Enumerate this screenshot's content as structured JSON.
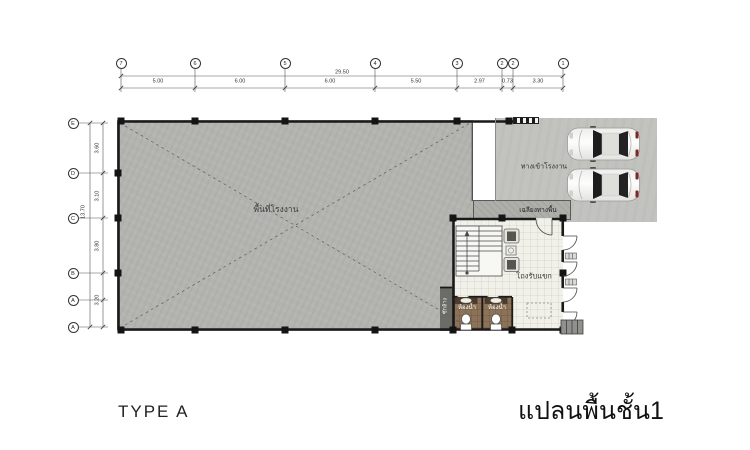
{
  "titles": {
    "type": "TYPE A",
    "plan": "แปลนพื้นชั้น1"
  },
  "grid": {
    "top": {
      "total": "29.50",
      "bubbles": [
        "7",
        "6",
        "5",
        "4",
        "3",
        "2",
        "2",
        "1"
      ],
      "segments": [
        "5.00",
        "6.00",
        "6.00",
        "5.50",
        "2.97",
        "0.73",
        "3.30"
      ]
    },
    "left": {
      "total": "13.70",
      "bubbles": [
        "E",
        "D",
        "C",
        "B",
        "A",
        "A"
      ],
      "segments": [
        "3.60",
        "3.10",
        "3.80",
        "3.20"
      ]
    }
  },
  "labels": {
    "factory_area": "พื้นที่โรงงาน",
    "entrance": "ทางเข้าโรงงาน",
    "porch": "เฉลียงทางพื้น",
    "reception_hall": "โถงรับแขก",
    "bathroom_1": "ห้องน้ำ",
    "bathroom_2": "ห้องน้ำ",
    "service_strip": "ซักล้าง"
  },
  "colors": {
    "factory_floor": "#b3b3af",
    "parking": "#c2c2be",
    "porch": "#aeaeaa",
    "reception_floor": "#f1f0e9",
    "bathroom_floor": "#8c7257",
    "wall": "#191919",
    "dimension_line": "#555555",
    "car_body": "#f2f2f0",
    "text": "#333333"
  }
}
